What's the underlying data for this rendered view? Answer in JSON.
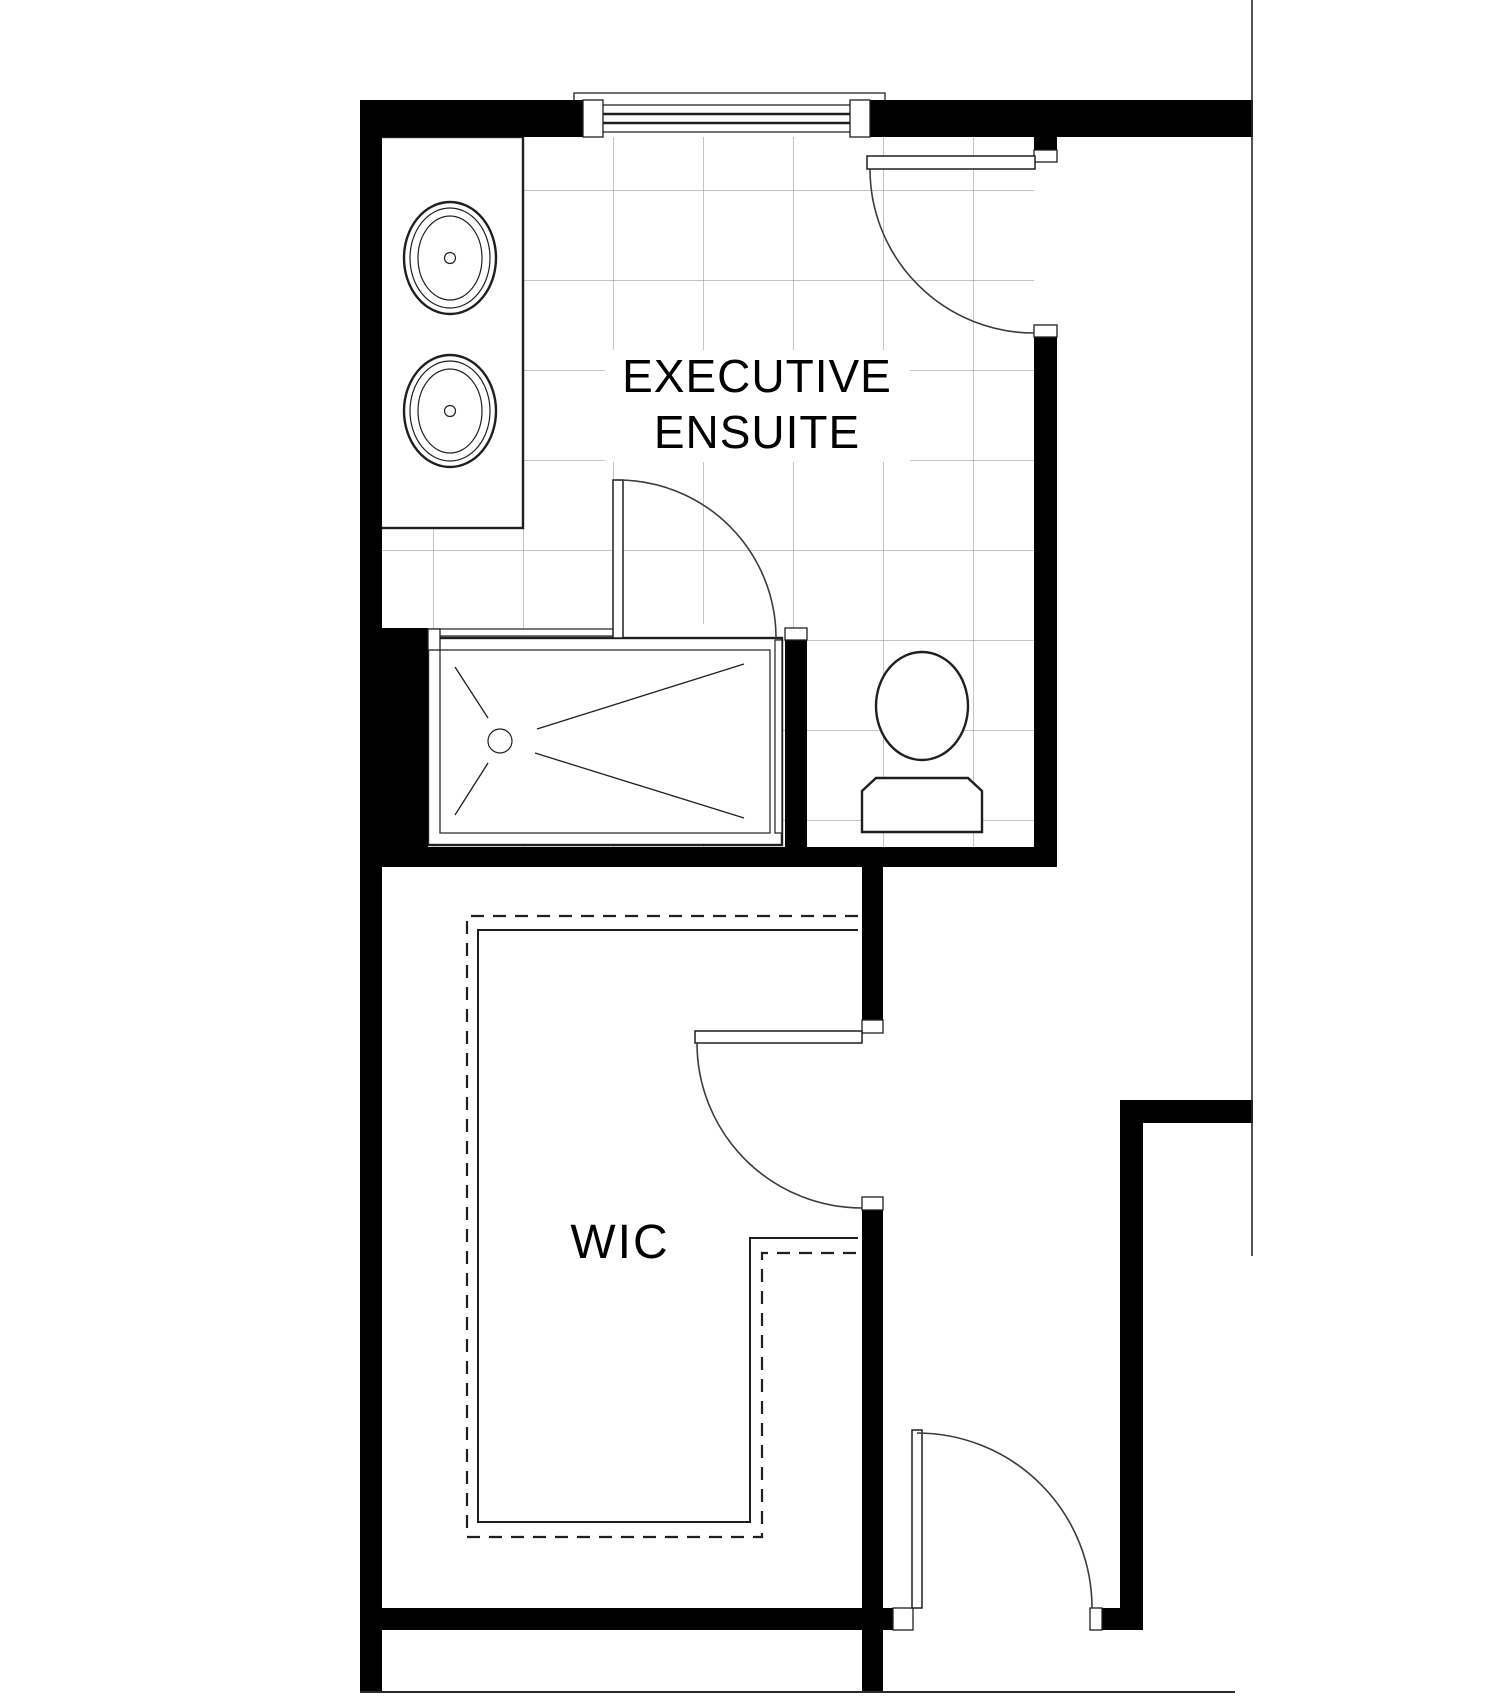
{
  "labels": {
    "room_ensuite_line1": "EXECUTIVE",
    "room_ensuite_line2": "ENSUITE",
    "room_wic": "WIC"
  },
  "colors": {
    "wall": "#000000",
    "line": "#1f1f1f",
    "grid": "#8a8a8a",
    "arc": "#3c3c3c",
    "background": "#ffffff"
  },
  "fixtures": [
    "window-icon",
    "double-vanity-icon",
    "sink-icon",
    "walk-in-shower-icon",
    "shower-drain-icon",
    "toilet-icon",
    "door-swing-icon",
    "closet-shelving-dashed-icon",
    "tile-grid-icon"
  ]
}
